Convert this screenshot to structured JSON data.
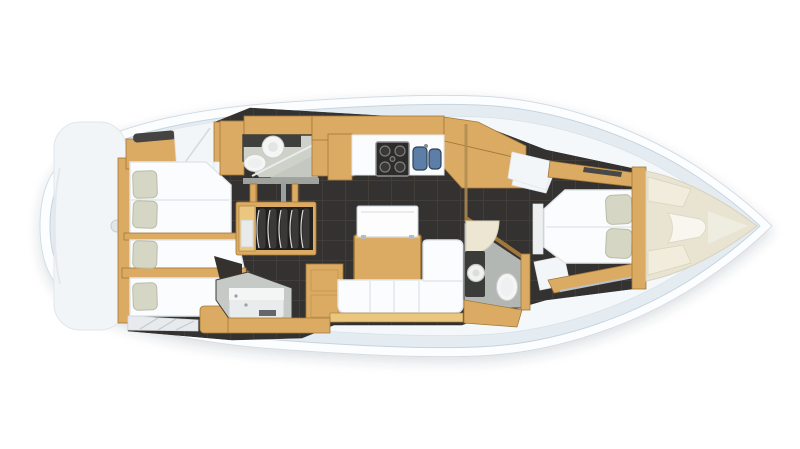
{
  "meta": {
    "page_title": "Sailing yacht interior deck plan",
    "view": "top-down cutaway floor plan, bow pointing right",
    "visible_text": []
  },
  "palette": {
    "hull": "#fcfdfe",
    "hullLine": "#d3dce3",
    "deck": "#e4ecf2",
    "deckInner": "#f4f8fa",
    "deckLine": "#c6d4df",
    "platform": "#f2f5f7",
    "wood": "#dcab63",
    "woodLight": "#eac67f",
    "woodDark": "#a2783a",
    "floor": "#343230",
    "floorLine": "#413e3a",
    "white": "#fbfcfd",
    "whiteLine": "#e2e6e9",
    "panel": "#f3f6f8",
    "pillow": "#d5d7c4",
    "pillowLine": "#b9bca8",
    "bathFloor": "#cdd1c8",
    "showerFloor": "#c6cac7",
    "wallDark": "#3c3a36",
    "glassLine": "#e8ecec",
    "fixtureWhite": "#f4f5f4",
    "darkCounter": "#3f3f3d",
    "sinkBlue": "#5d7ea6",
    "sinkBlueDark": "#2e4156",
    "cream": "#e9e4d1",
    "creamLine": "#d8d2bd",
    "creamCushion": "#f1ecdc",
    "stepsDark": "#232120",
    "slat": "#3b3937",
    "metal": "#9aa0a2"
  },
  "regions": [
    "aft-cabin-port",
    "aft-cabin-starboard",
    "port-head-bathroom",
    "starboard-shower-room",
    "companionway-steps",
    "galley",
    "saloon",
    "nav-area",
    "forward-head-bathroom",
    "owners-cabin",
    "forepeak-locker"
  ]
}
